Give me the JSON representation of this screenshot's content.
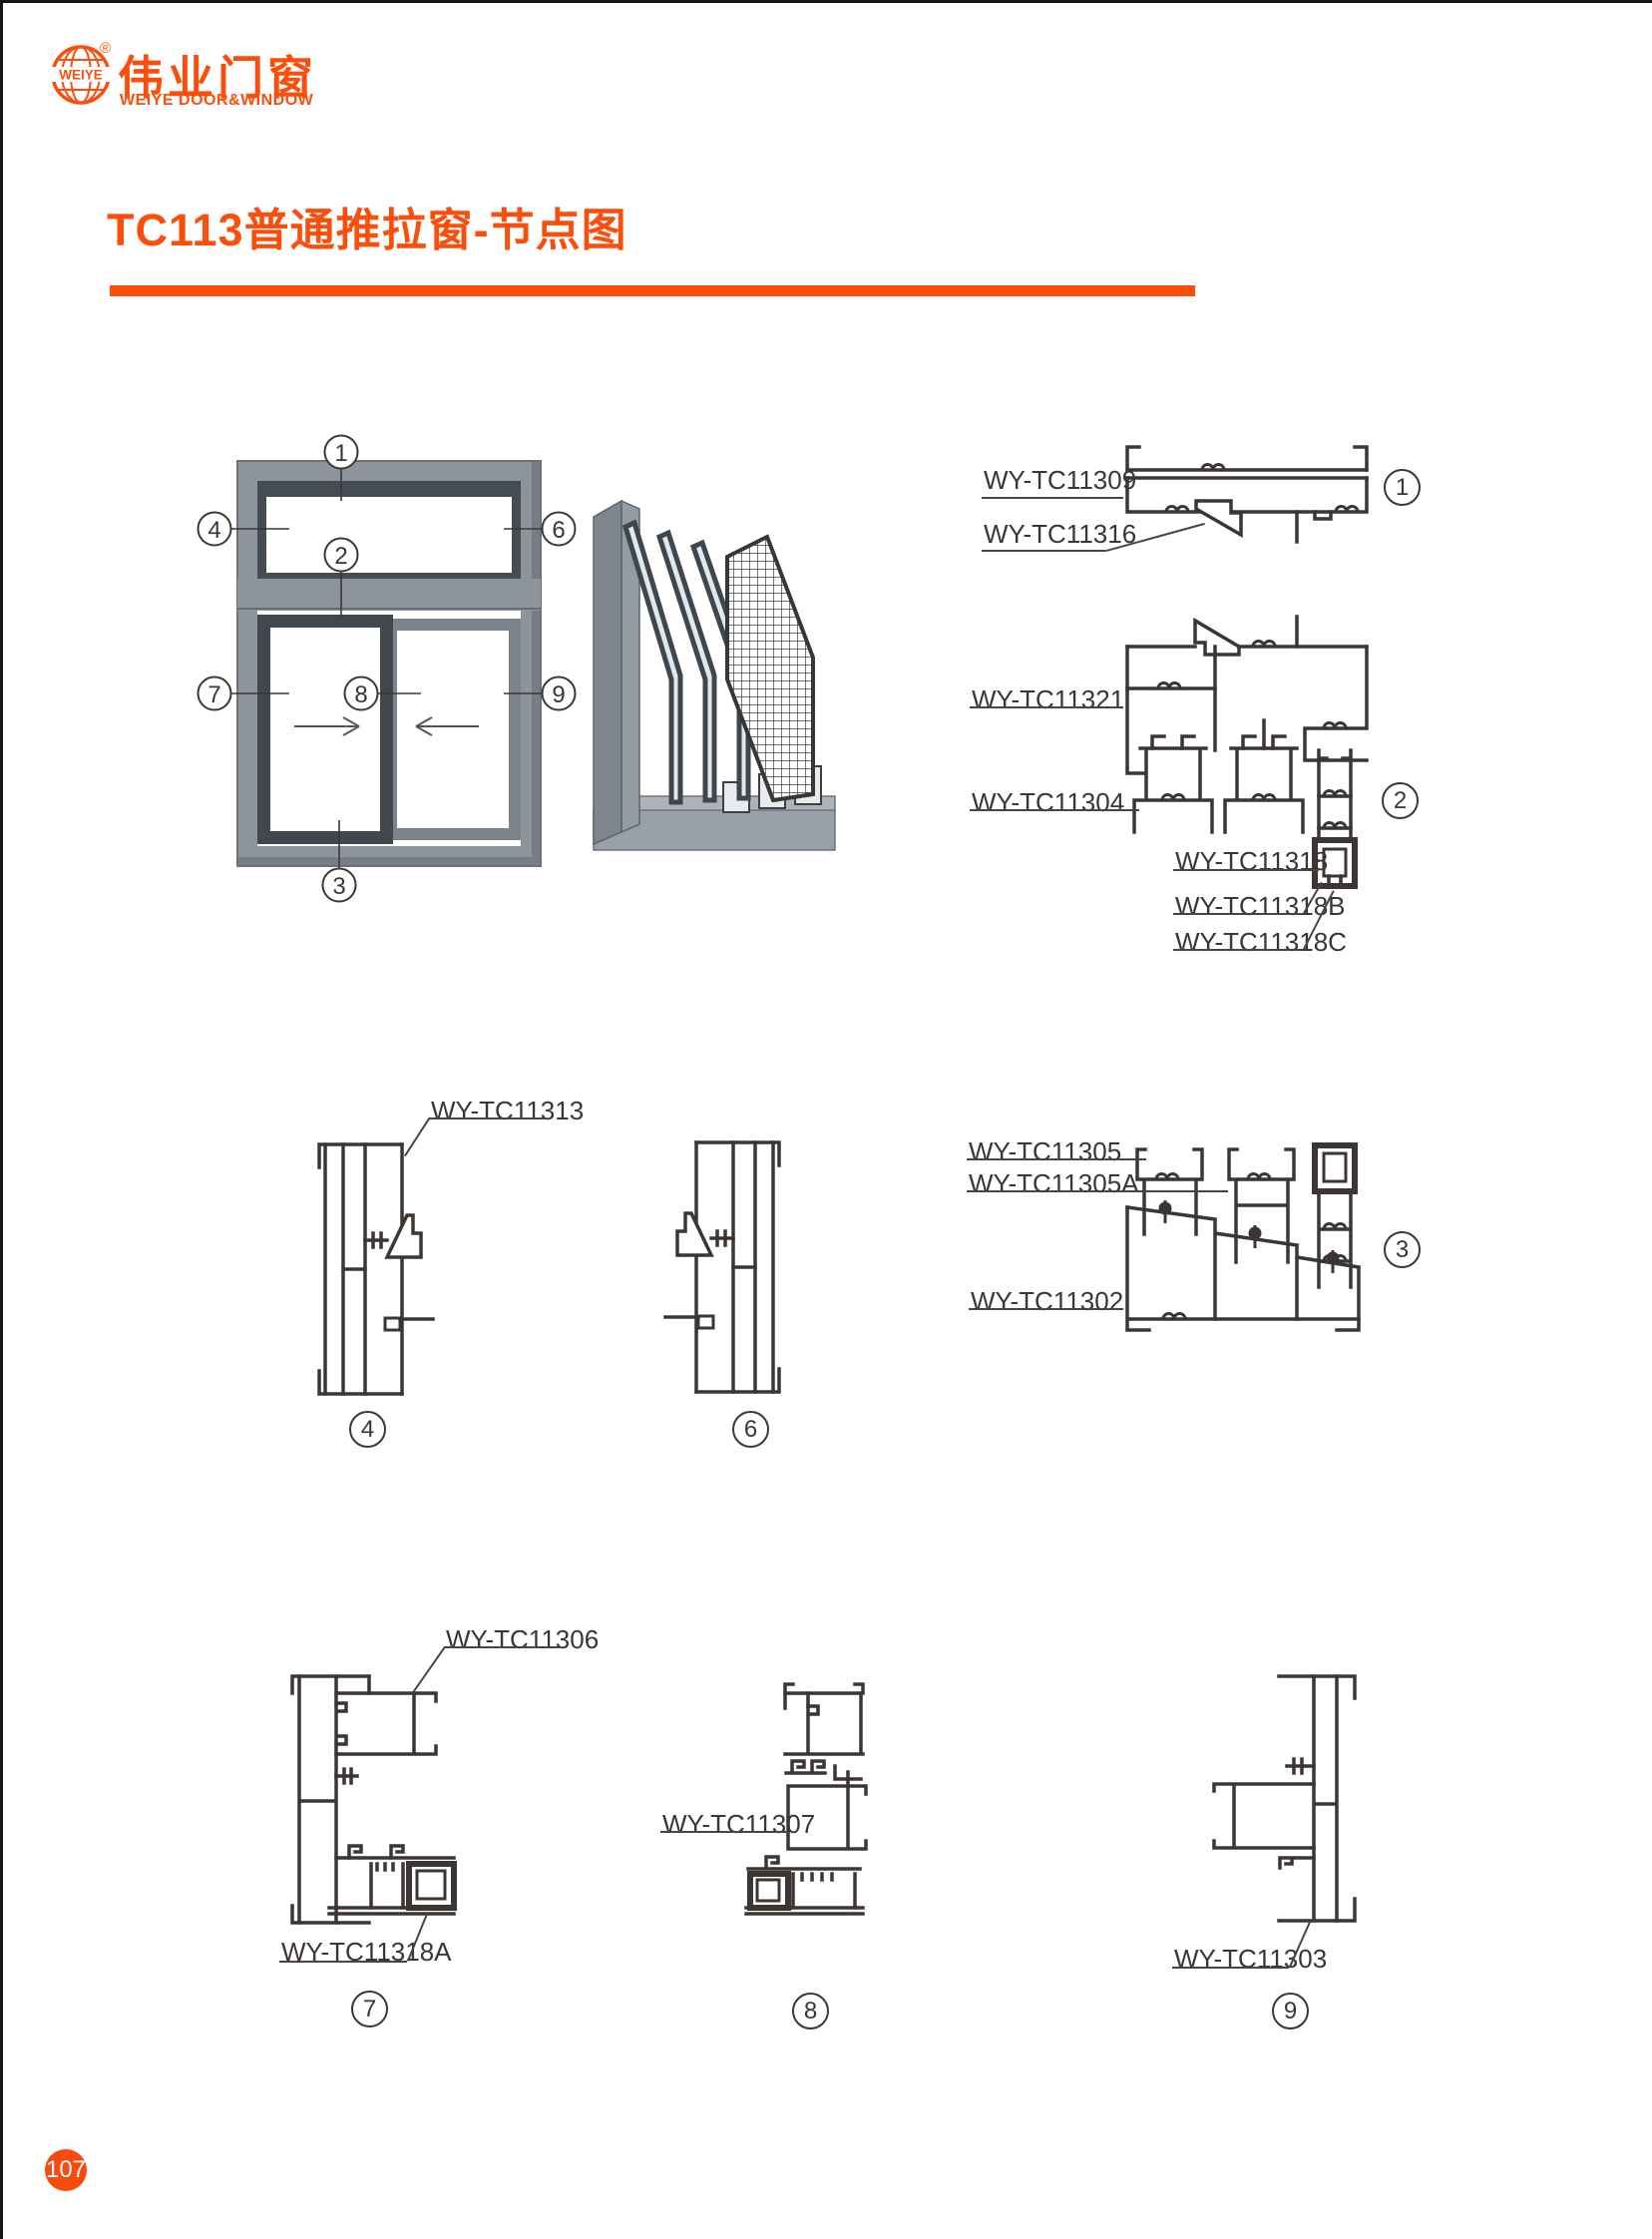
{
  "brand": {
    "globe_text": "WEIYE",
    "registered_mark": "®",
    "name_cn": "伟业门窗",
    "name_en": "WEIYE DOOR&WINDOW"
  },
  "page": {
    "title": "TC113普通推拉窗-节点图",
    "number": "107"
  },
  "colors": {
    "brand_orange": "#fa4e0d",
    "line_dark": "#3b3634",
    "frame_gray": "#8e949b",
    "sash_dark": "#40474e"
  },
  "elevation": {
    "callouts": {
      "c1": "1",
      "c2": "2",
      "c3": "3",
      "c4": "4",
      "c6": "6",
      "c7": "7",
      "c8": "8",
      "c9": "9"
    }
  },
  "details": {
    "d1": {
      "num": "1",
      "labels": {
        "l1": "WY-TC11309",
        "l2": "WY-TC11316"
      }
    },
    "d2": {
      "num": "2",
      "labels": {
        "l1": "WY-TC11321",
        "l2": "WY-TC11304",
        "l3": "WY-TC11318",
        "l4": "WY-TC11318B",
        "l5": "WY-TC11318C"
      }
    },
    "d3": {
      "num": "3",
      "labels": {
        "l1": "WY-TC11305",
        "l2": "WY-TC11305A",
        "l3": "WY-TC11302"
      }
    },
    "d4": {
      "num": "4",
      "labels": {
        "l1": "WY-TC11313"
      }
    },
    "d6": {
      "num": "6"
    },
    "d7": {
      "num": "7",
      "labels": {
        "l1": "WY-TC11306",
        "l2": "WY-TC11318A"
      }
    },
    "d8": {
      "num": "8",
      "labels": {
        "l1": "WY-TC11307"
      }
    },
    "d9": {
      "num": "9",
      "labels": {
        "l1": "WY-TC11303"
      }
    }
  }
}
